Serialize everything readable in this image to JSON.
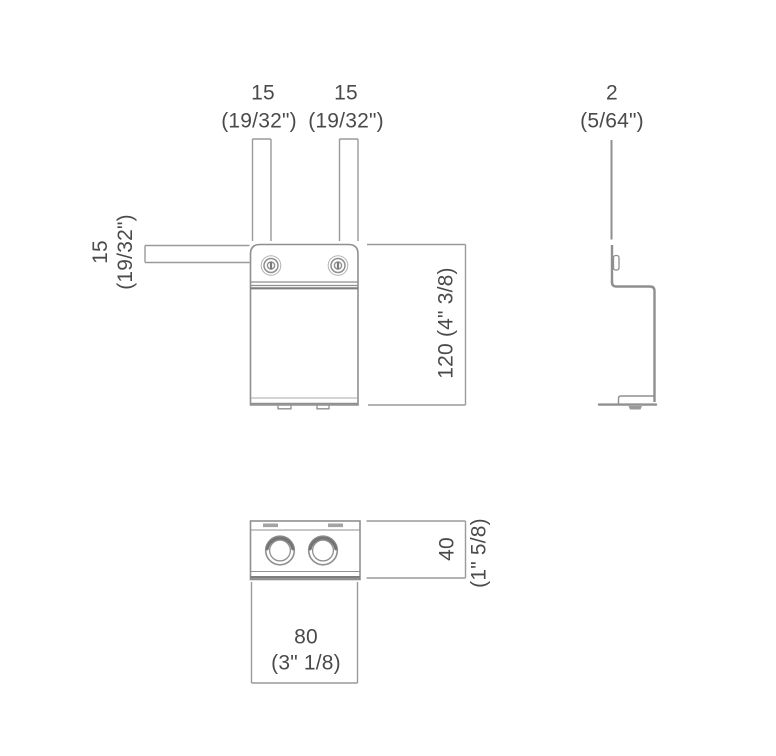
{
  "drawing_type": "technical-dimension-drawing",
  "views": {
    "front": {
      "dims": {
        "top_left": {
          "mm": "15",
          "inch": "(19/32\")"
        },
        "top_right": {
          "mm": "15",
          "inch": "(19/32\")"
        },
        "side_left": {
          "mm": "15",
          "inch": "(19/32\")"
        },
        "height": {
          "label": "120 (4\" 3/8)"
        }
      }
    },
    "side": {
      "dims": {
        "thickness": {
          "mm": "2",
          "inch": "(5/64\")"
        }
      }
    },
    "bottom": {
      "dims": {
        "depth": {
          "mm": "40",
          "inch": "(1\" 5/8)"
        },
        "width": {
          "mm": "80",
          "inch": "(3\" 1/8)"
        }
      }
    }
  },
  "colors": {
    "background": "#ffffff",
    "outline": "#8f8f8f",
    "dimension_line": "#9a9a9a",
    "dark_detail": "#7a7a7a",
    "text": "#4a4a4a"
  }
}
